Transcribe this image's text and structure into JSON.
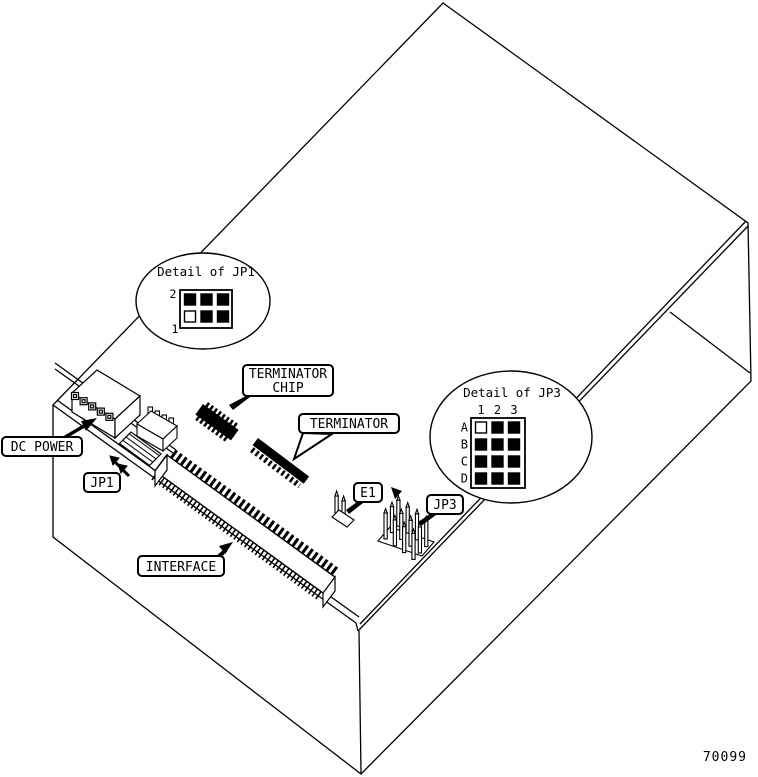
{
  "figure_number": "70099",
  "colors": {
    "line": "#000000",
    "background": "#ffffff",
    "chip_fill": "#000000"
  },
  "callouts": {
    "dc_power": "DC POWER",
    "jp1": "JP1",
    "terminator_chip_line1": "TERMINATOR",
    "terminator_chip_line2": "CHIP",
    "terminator": "TERMINATOR",
    "e1": "E1",
    "jp3": "JP3",
    "interface": "INTERFACE"
  },
  "detail_jp1": {
    "title": "Detail of JP1",
    "top_row_label": "2",
    "bottom_row_label": "1",
    "cells": [
      [
        "filled",
        "filled",
        "filled"
      ],
      [
        "open",
        "filled",
        "filled"
      ]
    ]
  },
  "detail_jp3": {
    "title": "Detail of JP3",
    "col_labels": [
      "1",
      "2",
      "3"
    ],
    "row_labels": [
      "A",
      "B",
      "C",
      "D"
    ],
    "cells": [
      [
        "open",
        "filled",
        "filled"
      ],
      [
        "filled",
        "filled",
        "filled"
      ],
      [
        "filled",
        "filled",
        "filled"
      ],
      [
        "filled",
        "filled",
        "filled"
      ]
    ]
  }
}
